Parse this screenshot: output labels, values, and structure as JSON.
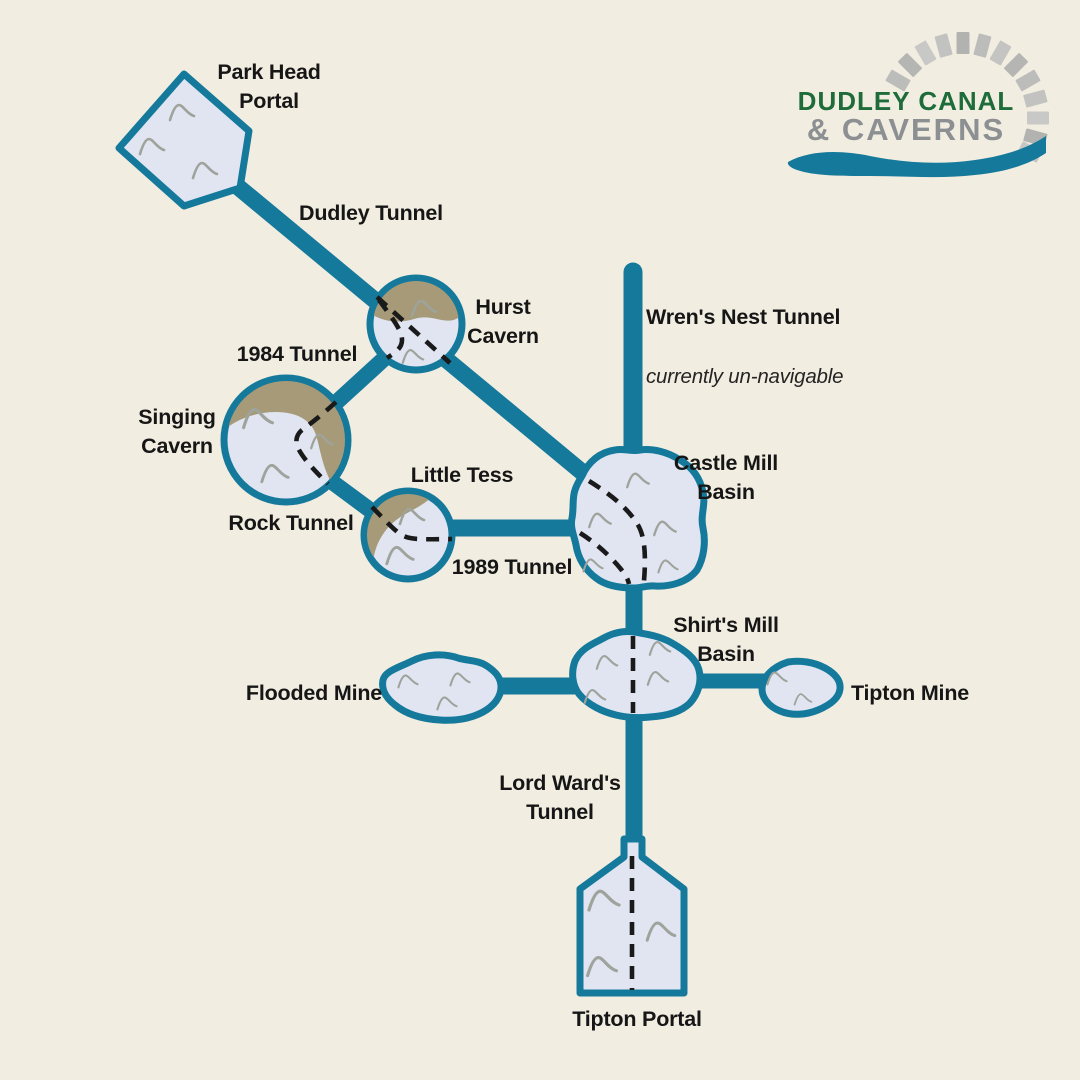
{
  "title": "Dudley Canal & Caverns tunnel and cavern map",
  "colors": {
    "background": "#F2EDE1",
    "tunnel_teal": "#15799B",
    "cavern_fill": "#E0E5F1",
    "cavern_border": "#15799B",
    "rock_tan": "#A79A78",
    "route_dash": "#1A1A1A",
    "wall_mark_gray": "#9EA39C",
    "label_color": "#161616",
    "logo_green": "#1E6C39",
    "logo_gray": "#8C9092",
    "stone_gray": "#BCBCBA"
  },
  "logo": {
    "line1": "DUDLEY CANAL",
    "line2": "& CAVERNS"
  },
  "labels": {
    "park_head_portal": "Park Head\nPortal",
    "dudley_tunnel": "Dudley Tunnel",
    "hurst_cavern": "Hurst\nCavern",
    "tunnel_1984": "1984 Tunnel",
    "singing_cavern": "Singing\nCavern",
    "rock_tunnel": "Rock Tunnel",
    "little_tess": "Little Tess",
    "tunnel_1989": "1989 Tunnel",
    "castle_mill_basin": "Castle Mill\nBasin",
    "wrens_nest_tunnel": "Wren's Nest Tunnel",
    "wrens_nest_note": "currently un-navigable",
    "shirts_mill_basin": "Shirt's Mill\nBasin",
    "flooded_mine": "Flooded Mine",
    "tipton_mine": "Tipton Mine",
    "lord_wards_tunnel": "Lord Ward's\nTunnel",
    "tipton_portal": "Tipton Portal"
  }
}
